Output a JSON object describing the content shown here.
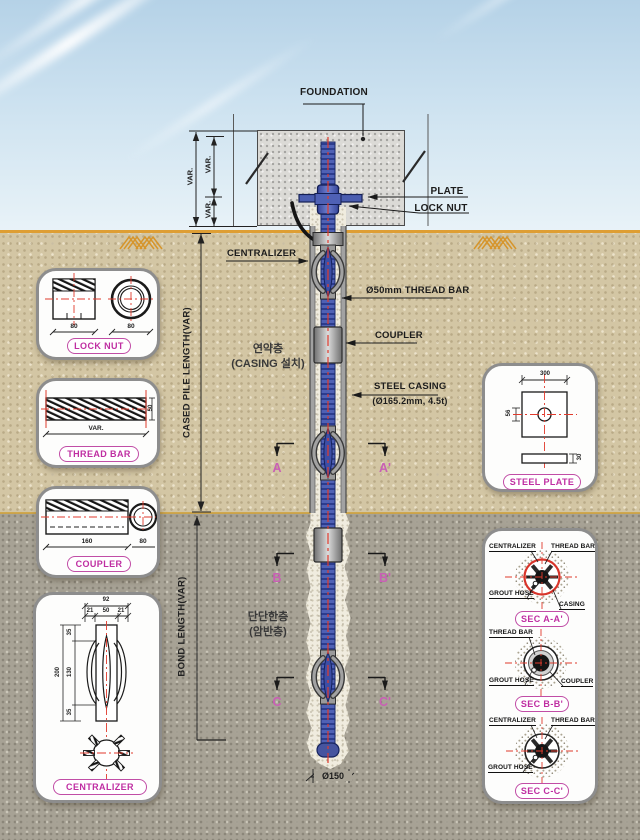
{
  "labels": {
    "foundation": "FOUNDATION",
    "plate": "PLATE",
    "lock_nut": "LOCK NUT",
    "centralizer": "CENTRALIZER",
    "thread_bar": "Ø50mm THREAD BAR",
    "coupler": "COUPLER",
    "steel_casing": "STEEL CASING",
    "steel_casing_spec": "(Ø165.2mm, 4.5t)",
    "soft_layer_1": "연약층",
    "soft_layer_2": "(CASING 설치)",
    "hard_layer_1": "단단한층",
    "hard_layer_2": "(암반층)",
    "cased_length": "CASED PILE LENGTH(VAR)",
    "bond_length": "BOND LENGTH(VAR)",
    "var": "VAR.",
    "bottom_dia": "Ø150"
  },
  "section_marks": {
    "a": "A",
    "a_p": "A'",
    "b": "B",
    "b_p": "B'",
    "c": "C",
    "c_p": "C'"
  },
  "callouts": {
    "lock_nut": {
      "title": "LOCK NUT",
      "dim_side": "80",
      "dim_round": "80"
    },
    "thread_bar": {
      "title": "THREAD BAR",
      "dim_len": "VAR.",
      "dim_dia": "50"
    },
    "coupler": {
      "title": "COUPLER",
      "dim_len": "160",
      "dim_dia": "80"
    },
    "centralizer": {
      "title": "CENTRALIZER",
      "dim_total_w": "92",
      "dim_w1": "21",
      "dim_w2": "50",
      "dim_w3": "21",
      "dim_total_h": "200",
      "dim_h1": "35",
      "dim_h2": "130",
      "dim_h3": "35"
    },
    "steel_plate": {
      "title": "STEEL PLATE",
      "dim_w": "300",
      "dim_hole": "56",
      "dim_t": "30"
    },
    "sec_a": {
      "title": "SEC A-A'",
      "labels": {
        "centralizer": "CENTRALIZER",
        "thread_bar": "THREAD BAR",
        "grout_hose": "GROUT HOSE",
        "casing": "CASING"
      }
    },
    "sec_b": {
      "title": "SEC B-B'",
      "labels": {
        "thread_bar": "THREAD BAR",
        "grout_hose": "GROUT HOSE",
        "coupler": "COUPLER"
      }
    },
    "sec_c": {
      "title": "SEC C-C'",
      "labels": {
        "centralizer": "CENTRALIZER",
        "thread_bar": "THREAD BAR",
        "grout_hose": "GROUT HOSE"
      }
    }
  },
  "colors": {
    "accent_pink": "#c14da6",
    "bar_blue": "#4a5db0",
    "ground_orange": "#de9e33",
    "centerline_red": "#e03a2c",
    "soil_tan": "#d3c6a4",
    "rock_gray": "#a7a295"
  }
}
